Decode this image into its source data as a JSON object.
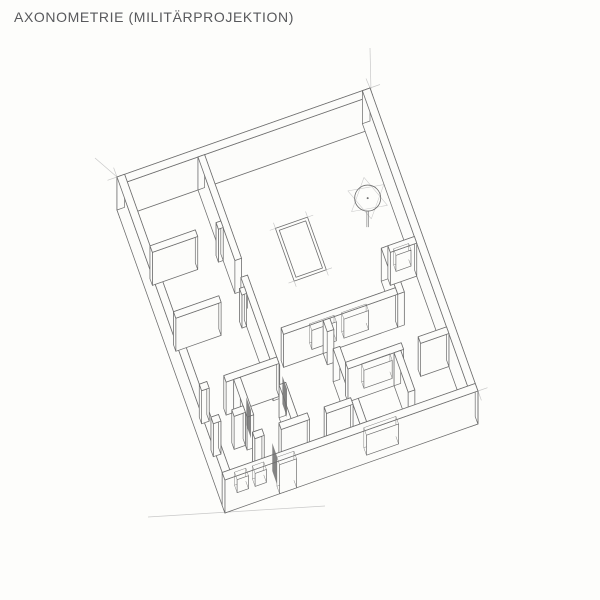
{
  "page": {
    "title": "AXONOMETRIE (MILITÄRPROJEKTION)",
    "background": "#fdfdfb"
  },
  "drawing": {
    "kind": "hand-drawn axonometric floor plan, military projection",
    "ink": "#6f6f6f",
    "faint": "#c3c3c3",
    "floor_line": "#9b9b9b",
    "paper": "#fcfcfa",
    "leaf_color": "#6e6e6e",
    "origin": [
      117,
      177
    ],
    "u_axis": [
      0.944,
      -0.332
    ],
    "v_axis": [
      0.335,
      0.941
    ],
    "plan_size": [
      268,
      322
    ],
    "wall_height": 33,
    "walls": [
      {
        "id": "outer-top-left",
        "rect": [
          0,
          0,
          268,
          8
        ]
      },
      {
        "id": "outer-left",
        "rect": [
          0,
          0,
          8,
          322
        ]
      },
      {
        "id": "outer-top-right",
        "rect": [
          260,
          0,
          268,
          322
        ]
      },
      {
        "id": "spine",
        "rect": [
          83,
          8,
          90,
          288
        ],
        "gaps": [
          [
            118,
            136
          ],
          [
            232,
            250
          ]
        ]
      },
      {
        "id": "partition-1",
        "rect": [
          8,
          76,
          83,
          83
        ],
        "gaps": [
          [
            56,
            78
          ]
        ]
      },
      {
        "id": "partition-2",
        "rect": [
          8,
          146,
          83,
          153
        ],
        "gaps": [
          [
            56,
            78
          ]
        ]
      },
      {
        "id": "right-room-side",
        "rect": [
          225,
          155,
          232,
          204
        ]
      },
      {
        "id": "right-room-top",
        "rect": [
          232,
          155,
          260,
          162
        ],
        "holes": [
          [
            238,
            254,
            12,
            28
          ]
        ]
      },
      {
        "id": "living-lower",
        "rect": [
          104,
          197,
          225,
          204
        ],
        "holes": [
          [
            134,
            160,
            8,
            27
          ],
          [
            168,
            194,
            8,
            27
          ]
        ]
      },
      {
        "id": "partition-3",
        "rect": [
          8,
          223,
          90,
          230
        ],
        "gaps": [
          [
            16,
            34
          ]
        ]
      },
      {
        "id": "wc-side",
        "rect": [
          42,
          230,
          49,
          290
        ],
        "gaps": [
          [
            270,
            286
          ]
        ]
      },
      {
        "id": "wc-front",
        "rect": [
          8,
          258,
          42,
          265
        ],
        "gaps": [
          [
            16,
            30
          ]
        ]
      },
      {
        "id": "lower-mid-v",
        "rect": [
          146,
          204,
          153,
          314
        ],
        "gaps": [
          [
            216,
            234
          ]
        ]
      },
      {
        "id": "lower-mid-h",
        "rect": [
          153,
          251,
          260,
          258
        ],
        "holes": [
          [
            170,
            200,
            8,
            26
          ]
        ],
        "gaps": [
          [
            212,
            230
          ]
        ]
      },
      {
        "id": "lower-v2",
        "rect": [
          202,
          258,
          209,
          300
        ]
      },
      {
        "id": "hall-h",
        "rect": [
          42,
          286,
          146,
          293
        ],
        "gaps": [
          [
            52,
            70
          ],
          [
            100,
            118
          ]
        ]
      },
      {
        "id": "outer-bottom-right",
        "rect": [
          0,
          314,
          268,
          322
        ],
        "holes": [
          [
            13,
            25,
            16,
            29
          ],
          [
            32,
            44,
            16,
            29
          ],
          [
            58,
            76,
            0,
            29
          ],
          [
            150,
            184,
            8,
            28
          ]
        ]
      }
    ],
    "skylight": {
      "rect": [
        143,
        70,
        177,
        126
      ],
      "inset": 3,
      "tick": 6
    },
    "pendant": {
      "center": [
        240,
        72
      ],
      "radius": 13,
      "stem": 16,
      "star_radius": 21
    },
    "door_leaves": [
      {
        "a": [
          49,
          248
        ],
        "b": [
          49,
          262
        ]
      },
      {
        "a": [
          90,
          240
        ],
        "b": [
          90,
          254
        ]
      },
      {
        "a": [
          58,
          300
        ],
        "b": [
          58,
          314
        ]
      }
    ],
    "guides": [
      [
        [
          370,
          48
        ],
        [
          371,
          92
        ]
      ],
      [
        [
          370,
          88
        ],
        [
          380,
          84.5
        ]
      ],
      [
        [
          366,
          78.5
        ],
        [
          370,
          88
        ]
      ],
      [
        [
          117,
          177
        ],
        [
          107.5,
          180.3
        ]
      ],
      [
        [
          117,
          177
        ],
        [
          113.6,
          167.6
        ]
      ],
      [
        [
          95,
          158
        ],
        [
          117,
          177
        ]
      ],
      [
        [
          478,
          391
        ],
        [
          487.5,
          387.7
        ]
      ],
      [
        [
          478,
          391
        ],
        [
          481.4,
          400.4
        ]
      ],
      [
        [
          148,
          517
        ],
        [
          325,
          506
        ]
      ],
      [
        [
          366,
          431
        ],
        [
          365,
          421
        ]
      ],
      [
        [
          398,
          420
        ],
        [
          397,
          410
        ]
      ]
    ]
  }
}
